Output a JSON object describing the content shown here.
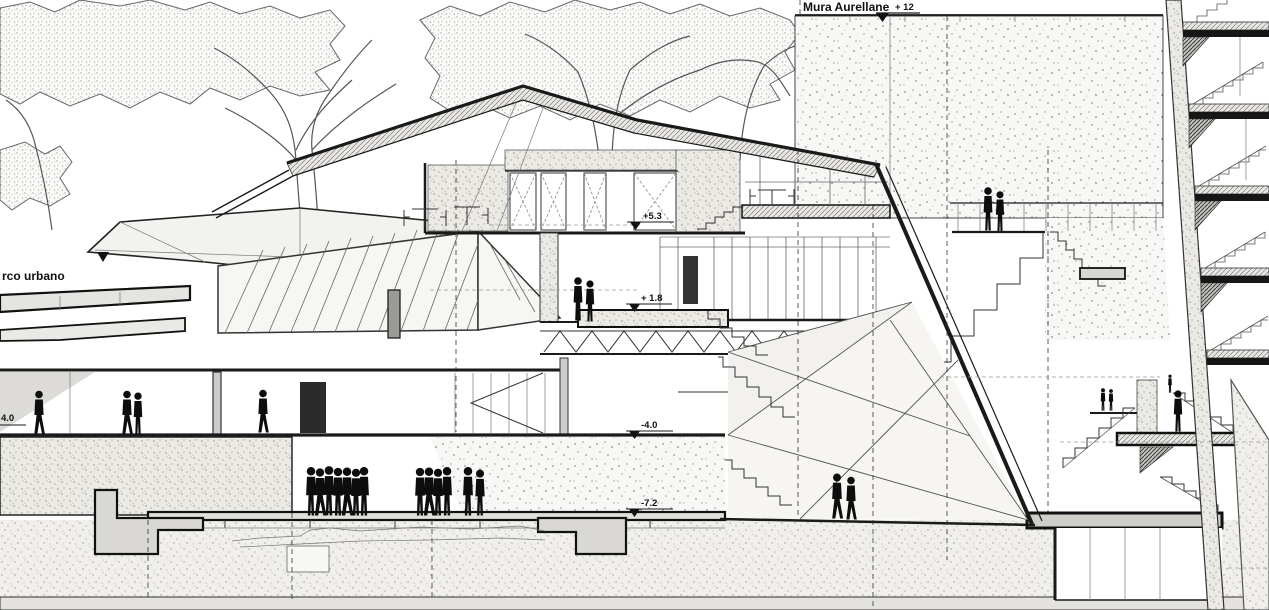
{
  "drawing": {
    "type": "architectural-section",
    "labels": {
      "wall": "Mura Aurellane",
      "park": "rco urbano"
    },
    "markers": {
      "m12": "+ 12",
      "m53": "+5.3",
      "m18": "+ 1.8",
      "m40": "-4.0",
      "m72": "-7.2",
      "m40left": "4.0"
    },
    "colors": {
      "ink": "#1a1a1a",
      "paper": "#ffffff",
      "silhouette": "#0d0d0d",
      "concrete_fill": "#eceae5",
      "slab_fill": "#d8d7d3",
      "earth_fill": "#f0efec"
    }
  }
}
